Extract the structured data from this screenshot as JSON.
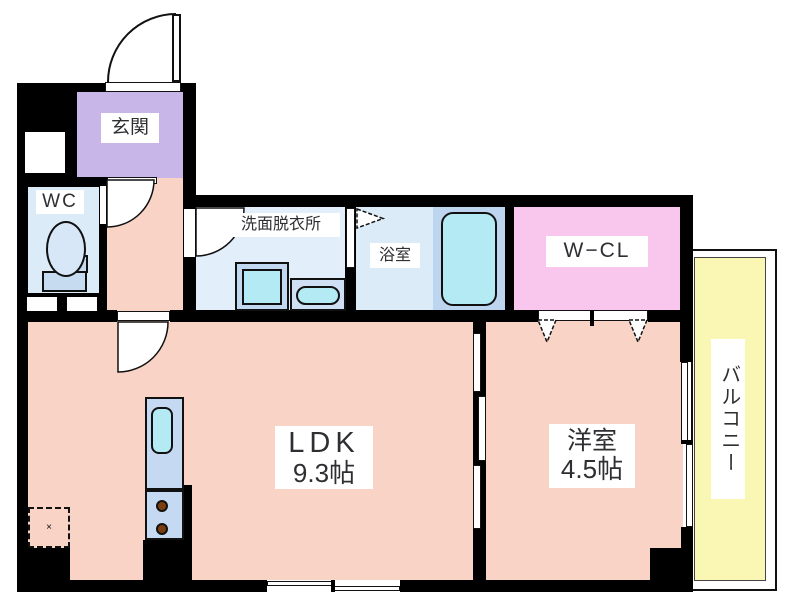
{
  "title": "1LDK apartment floor plan",
  "rooms": {
    "genkan": {
      "label": "玄関"
    },
    "wc": {
      "label": "WC"
    },
    "washroom": {
      "label": "洗面脱衣所"
    },
    "bathroom": {
      "label": "浴室"
    },
    "wcl": {
      "label": "W−CL"
    },
    "ldk": {
      "label": "LDK",
      "size": "9.3帖"
    },
    "western": {
      "label": "洋室",
      "size": "4.5帖"
    },
    "balcony": {
      "label": "バルコニー"
    }
  },
  "fixtures": {
    "refrigerator_mark": "×",
    "icons": [
      "entrance-door-swing",
      "toilet-icon",
      "washing-machine-icon",
      "vanity-sink-icon",
      "bathtub-icon",
      "kitchen-sink-icon",
      "stove-burner-icon",
      "door-swing-arc",
      "folding-door-triangle-icon",
      "sliding-door-panels",
      "refrigerator-space"
    ]
  },
  "colors": {
    "wall": "#000000",
    "ink": "#2f2f33",
    "salmon": "#f8d3c6",
    "purple": "#c9b6e8",
    "blue": "#dcebf8",
    "bluepale": "#e2eefa",
    "bluetub": "#bdd5ef",
    "cyan": "#b3eaf4",
    "counter": "#c5daf2",
    "pink": "#f9c6ee",
    "yellow": "#faf7b4",
    "brown": "#7b3d10"
  }
}
